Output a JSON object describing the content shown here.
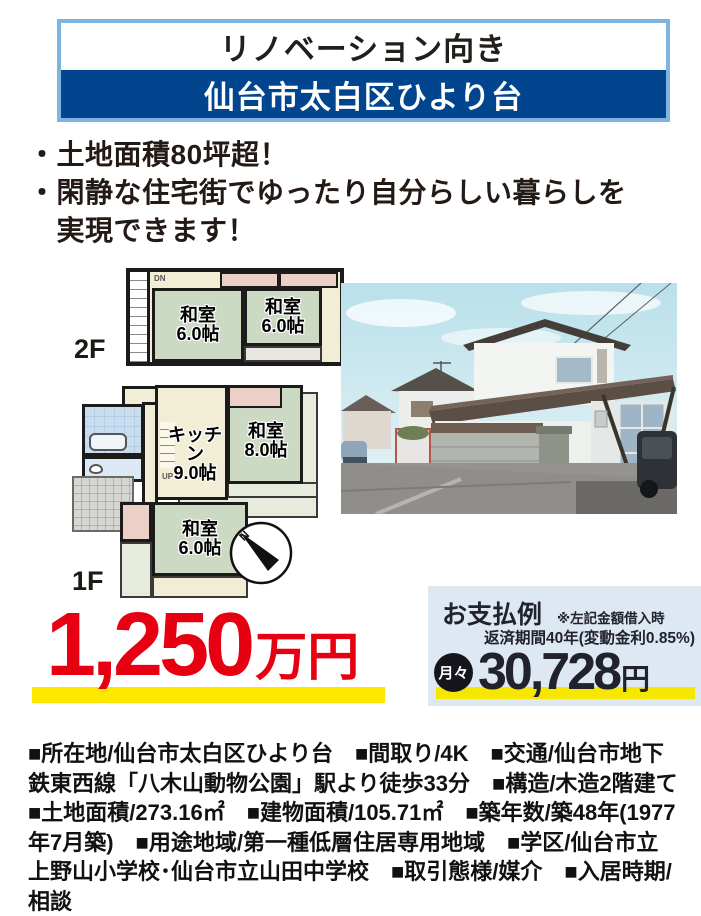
{
  "header": {
    "tagline": "リノベーション向き",
    "location": "仙台市太白区ひより台"
  },
  "highlights": {
    "line1": "・土地面積80坪超！",
    "line2": "・閑静な住宅街でゆったり自分らしい暮らしを",
    "line3": "　実現できます！"
  },
  "floorplan": {
    "floor2_label": "2F",
    "floor1_label": "1F",
    "stair_down_label": "DN",
    "stair_up_label": "UP",
    "compass_label": "N",
    "rooms_2f": [
      {
        "name": "和室",
        "size": "6.0帖"
      },
      {
        "name": "和室",
        "size": "6.0帖"
      }
    ],
    "rooms_1f": [
      {
        "name": "キッチン",
        "size": "9.0帖"
      },
      {
        "name": "和室",
        "size": "8.0帖"
      },
      {
        "name": "和室",
        "size": "6.0帖"
      }
    ]
  },
  "price": {
    "amount": "1,250",
    "unit": "万円"
  },
  "payment": {
    "title": "お支払例",
    "note1": "※左記金額借入時",
    "note2": "返済期間40年(変動金利0.85%)",
    "monthly_label": "月々",
    "monthly_amount": "30,728",
    "monthly_unit": "円"
  },
  "details": {
    "text": "■所在地/仙台市太白区ひより台　■間取り/4K　■交通/仙台市地下鉄東西線「八木山動物公園」駅より徒歩33分　■構造/木造2階建て　■土地面積/273.16㎡　■建物面積/105.71㎡　■築年数/築48年(1977年7月築)　■用途地域/第一種低層住居専用地域　■学区/仙台市立上野山小学校･仙台市立山田中学校　■取引態様/媒介　■入居時期/相談"
  },
  "colors": {
    "accent_blue": "#00458e",
    "border_blue": "#7db4e0",
    "price_red": "#e60012",
    "highlight_yellow": "#ffe800",
    "payment_bg": "#dde8f3"
  }
}
